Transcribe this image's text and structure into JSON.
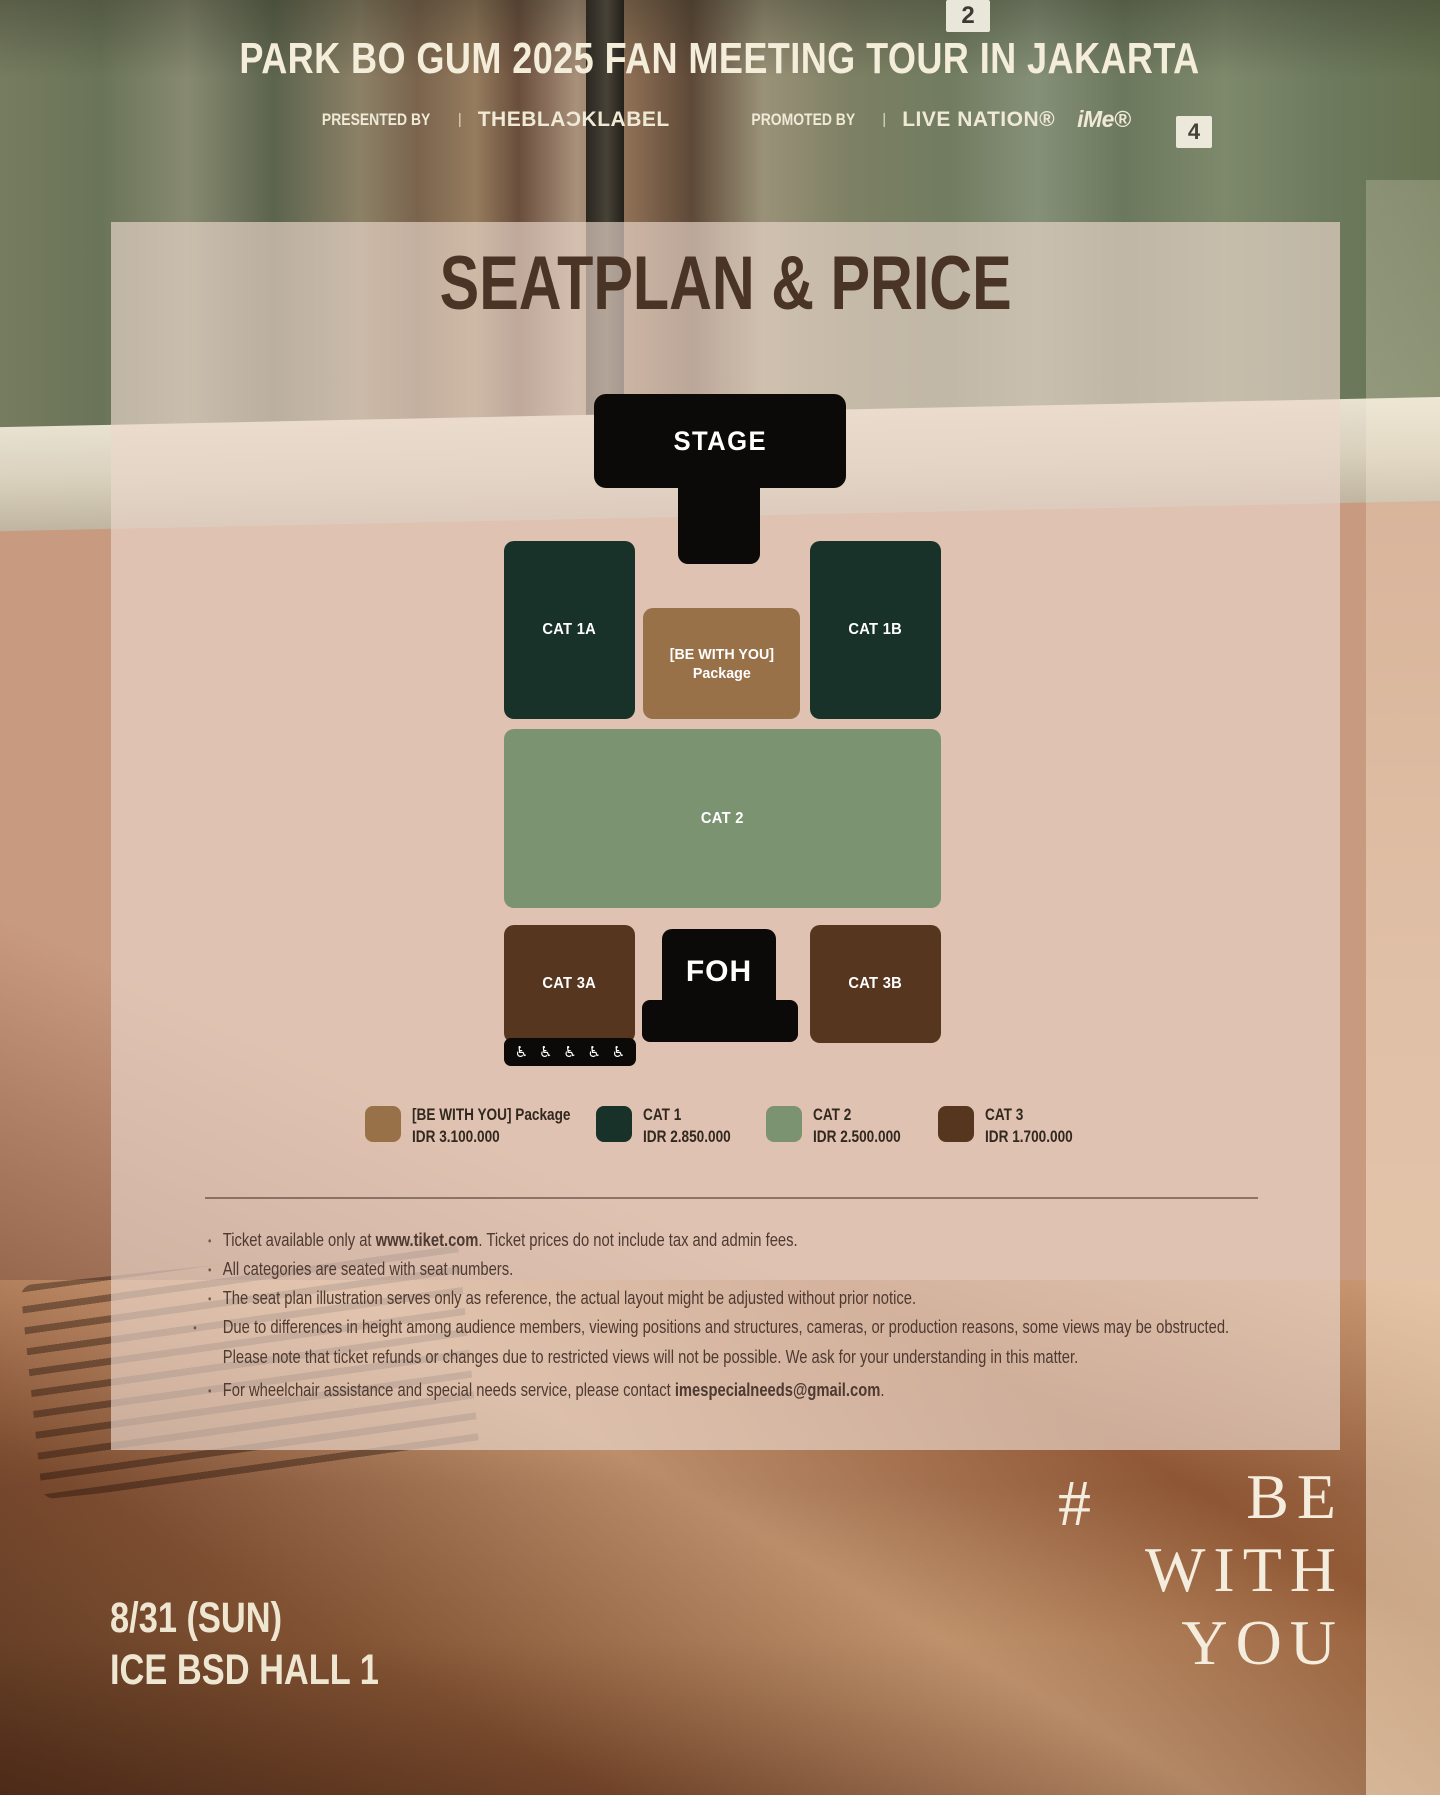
{
  "header": {
    "title": "PARK BO GUM 2025 FAN MEETING TOUR IN JAKARTA",
    "presented_by_label": "PRESENTED BY",
    "presented_by_sep": "|",
    "presented_by_value": "THEBLAƆKLABEL",
    "promoted_by_label": "PROMOTED BY",
    "promoted_by_sep": "|",
    "promoted_by_value": "LIVE NATION®",
    "promoted_by_value2": "iMe®"
  },
  "background": {
    "sign_top": "2",
    "sign_mid": "4"
  },
  "panel": {
    "title": "SEATPLAN & PRICE",
    "colors": {
      "stage_black": "#0b0a08",
      "cat1": "#183229",
      "cat2": "#7c9372",
      "cat3": "#57361f",
      "package": "#997149"
    },
    "seatmap": {
      "stage_label": "STAGE",
      "cat1a_label": "CAT 1A",
      "cat1b_label": "CAT 1B",
      "package_line1": "[BE WITH YOU]",
      "package_line2": "Package",
      "cat2_label": "CAT 2",
      "cat3a_label": "CAT 3A",
      "cat3b_label": "CAT 3B",
      "foh_label": "FOH",
      "wheelchair_icon": "♿"
    },
    "legend": [
      {
        "name": "[BE WITH YOU] Package",
        "price": "IDR 3.100.000",
        "color": "#997149"
      },
      {
        "name": "CAT 1",
        "price": "IDR 2.850.000",
        "color": "#183229"
      },
      {
        "name": "CAT 2",
        "price": "IDR 2.500.000",
        "color": "#7c9372"
      },
      {
        "name": "CAT 3",
        "price": "IDR 1.700.000",
        "color": "#57361f"
      }
    ],
    "notes": [
      {
        "pre": "Ticket available only at ",
        "bold": "www.tiket.com",
        "post": ". Ticket prices do not include tax and admin fees."
      },
      {
        "pre": "All categories are seated with seat numbers.",
        "bold": "",
        "post": ""
      },
      {
        "pre": "The seat plan illustration serves only as reference, the actual layout might be adjusted without prior notice.",
        "bold": "",
        "post": ""
      },
      {
        "pre": "Due to differences in height among audience members, viewing positions and structures, cameras, or production reasons, some views may be obstructed. Please note that ticket refunds or changes due to restricted views will not be possible. We ask for your understanding in this matter.",
        "bold": "",
        "post": ""
      },
      {
        "pre": "For wheelchair assistance and special needs service, please contact ",
        "bold": "imespecialneeds@gmail.com",
        "post": "."
      }
    ]
  },
  "footer": {
    "date": "8/31 (SUN)",
    "venue": "ICE BSD HALL 1",
    "hashtag_symbol": "#",
    "hashtag_lines": [
      "BE",
      "WITH",
      "YOU"
    ]
  }
}
